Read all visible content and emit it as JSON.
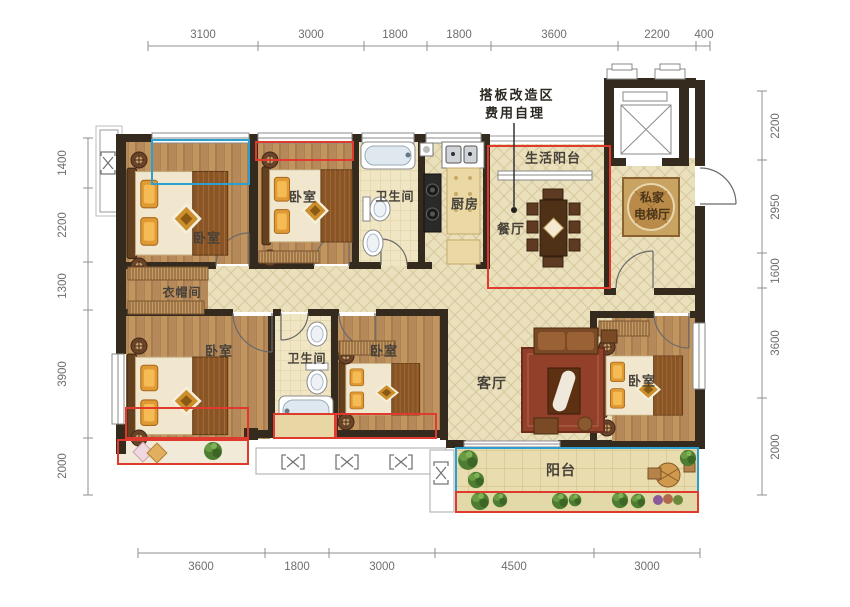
{
  "annotation": {
    "line1": "搭板改造区",
    "line2": "费用自理"
  },
  "rooms": {
    "bedroom_tl": "卧室",
    "bedroom_tm": "卧室",
    "bath_top": "卫生间",
    "kitchen": "厨房",
    "life_balcony": "生活阳台",
    "dining": "餐厅",
    "elevator_hall_l1": "私家",
    "elevator_hall_l2": "电梯厅",
    "cloakroom": "衣帽间",
    "bedroom_bl": "卧室",
    "bath_bottom": "卫生间",
    "bedroom_bm": "卧室",
    "living": "客厅",
    "bedroom_br": "卧室",
    "balcony": "阳台"
  },
  "dimensions": {
    "top": [
      "3100",
      "3000",
      "1800",
      "1800",
      "3600",
      "2200",
      "400"
    ],
    "bottom": [
      "3600",
      "1800",
      "3000",
      "4500",
      "3000"
    ],
    "left": [
      "1400",
      "2200",
      "1300",
      "3900",
      "2000"
    ],
    "right": [
      "2200",
      "2950",
      "1600",
      "3600",
      "2000"
    ]
  },
  "colors": {
    "wall": "#352a1e",
    "red_zone": "#e03a2e",
    "blue_zone": "#2b9fd0",
    "wood": "#b5895a",
    "tile": "#eae0bc",
    "dim_text": "#6e6e6e"
  }
}
